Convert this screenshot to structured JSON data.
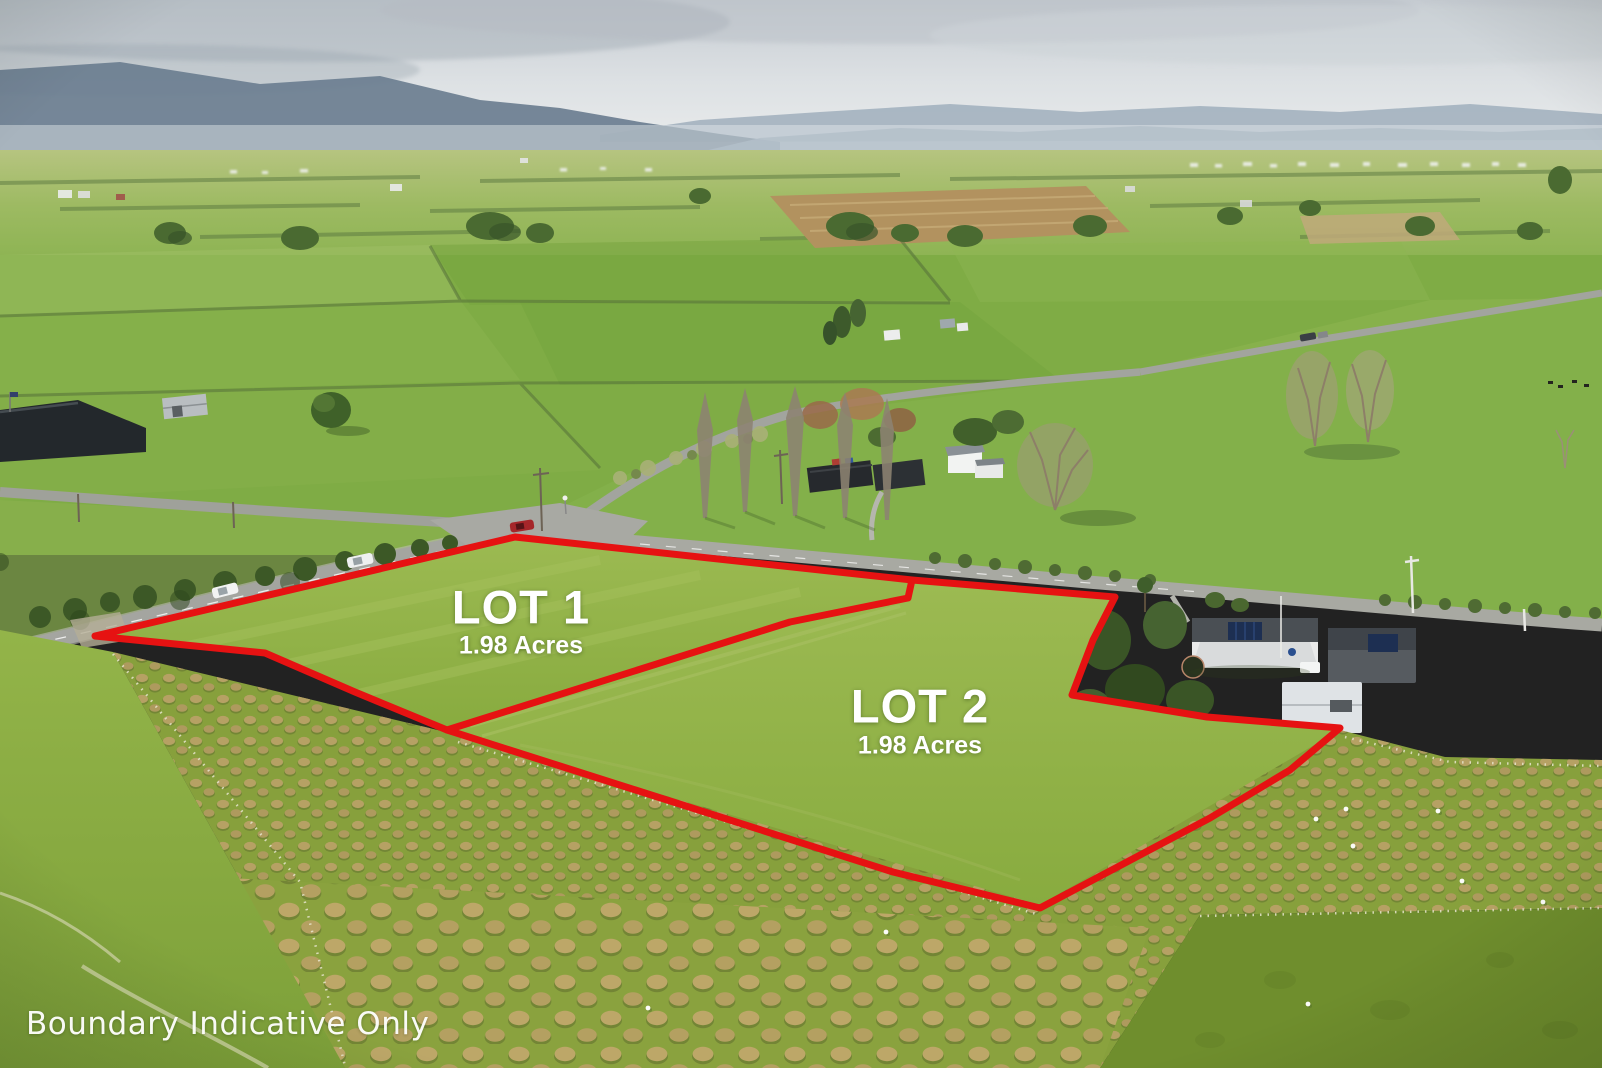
{
  "photo": {
    "kind": "aerial-drone-photograph",
    "subject": "rural lifestyle subdivision paddocks with road intersection, farm houses and sheep paddocks"
  },
  "watermark": {
    "text": "Boundary Indicative Only"
  },
  "lots": [
    {
      "name": "LOT 1",
      "area": "1.98 Acres"
    },
    {
      "name": "LOT 2",
      "area": "1.98 Acres"
    }
  ],
  "boundary": {
    "color": "#e61212",
    "style": "solid",
    "label_color": "#ffffff"
  },
  "palette": {
    "sky_haze": "#dfe3e6",
    "mountains_far": "#a3b1bf",
    "mountains_near": "#74869a",
    "pasture_green": "#8fb044",
    "lot_green": "#95b548",
    "mound_tan": "#b5a163",
    "road_grey": "#a6a7a1",
    "tree_dark_green": "#3f5c28",
    "text_white": "#ffffff"
  }
}
